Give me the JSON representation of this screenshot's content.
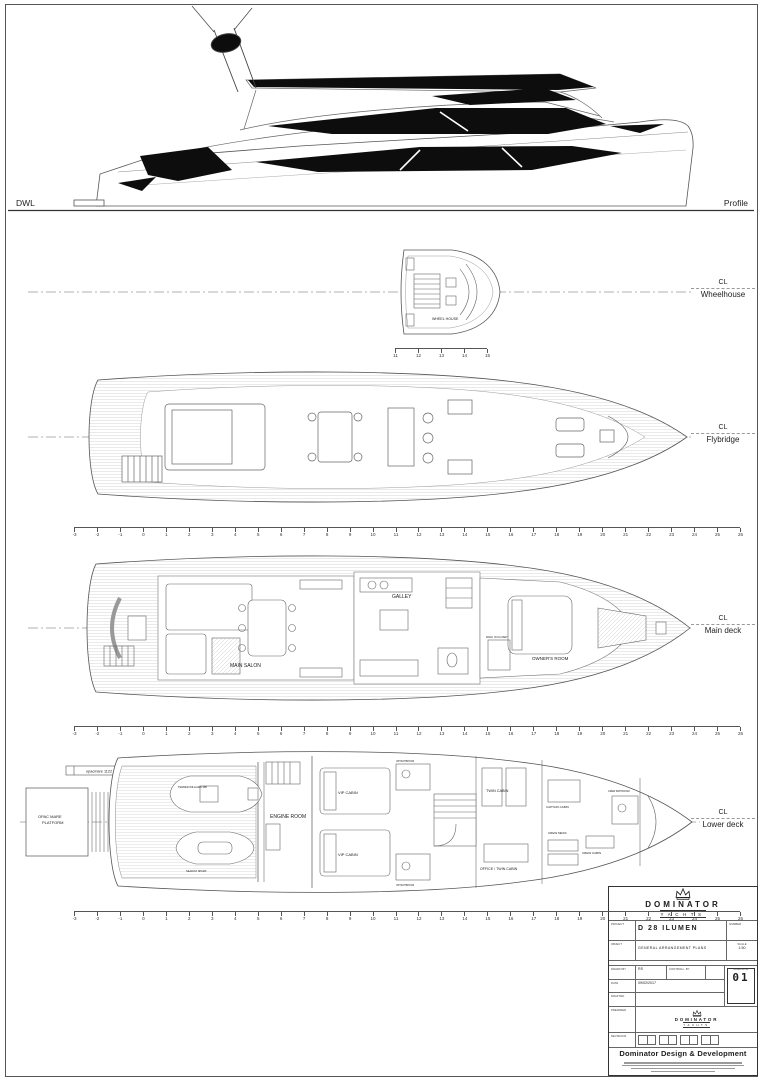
{
  "profile": {
    "dwl": "DWL",
    "label": "Profile"
  },
  "cl": "CL",
  "decks": {
    "wheelhouse": "Wheelhouse",
    "flybridge": "Flybridge",
    "main": "Main deck",
    "lower": "Lower deck"
  },
  "wheelhouse": {
    "room": "WHEEL HOUSE"
  },
  "main_deck": {
    "salon": "MAIN SALON",
    "galley": "GALLEY",
    "owners": "OWNER'S ROOM",
    "closet": "WALK IN CLOSET"
  },
  "lower_deck": {
    "platform1": "OPAC MARE",
    "platform2": "PLATFORM",
    "passerelle": "opacmare 1122",
    "engine": "ENGINE ROOM",
    "vip1": "VIP CABIN",
    "vip2": "VIP CABIN",
    "vip_bath1": "VIP BATHROOM",
    "vip_bath2": "VIP BATHROOM",
    "twin": "TWIN CABIN",
    "office": "OFFICE / TWIN CABIN",
    "captain": "CAPTAIN CABIN",
    "crew_mess": "CREW MESS",
    "crew_cabin": "CREW CABIN",
    "crew_bath": "CREW BATHROOM",
    "tender": "TENDER WILLIAMS 385",
    "jetski": "SEADOO SPARK"
  },
  "rulers": {
    "stations": {
      "from": -3,
      "to": 26
    },
    "wheelhouse": {
      "from": 11,
      "to": 15
    }
  },
  "titleblock": {
    "brand": "DOMINATOR",
    "brand_sub": "YACHTS",
    "project_label": "PROJECT",
    "project": "D 28 ILUMEN",
    "number_label": "NUMBER",
    "object_label": "OBJECT",
    "object": "GENERAL ARRANGEMENT PLANS",
    "scale_label": "SCALE",
    "scale": "1:50",
    "drawn_label": "DRAWN BY",
    "drawn": "RS",
    "controlled_label": "CONTROLL. BY",
    "drawing_nr_label": "DRAWING NR",
    "drawing_nr": "01",
    "date_label": "DATE",
    "date": "09/02/2017",
    "drafted_label": "DRAFTED",
    "prepared_label": "PREPARED",
    "revisions_label": "REVISIONS",
    "footer": "Dominator Design & Development"
  }
}
